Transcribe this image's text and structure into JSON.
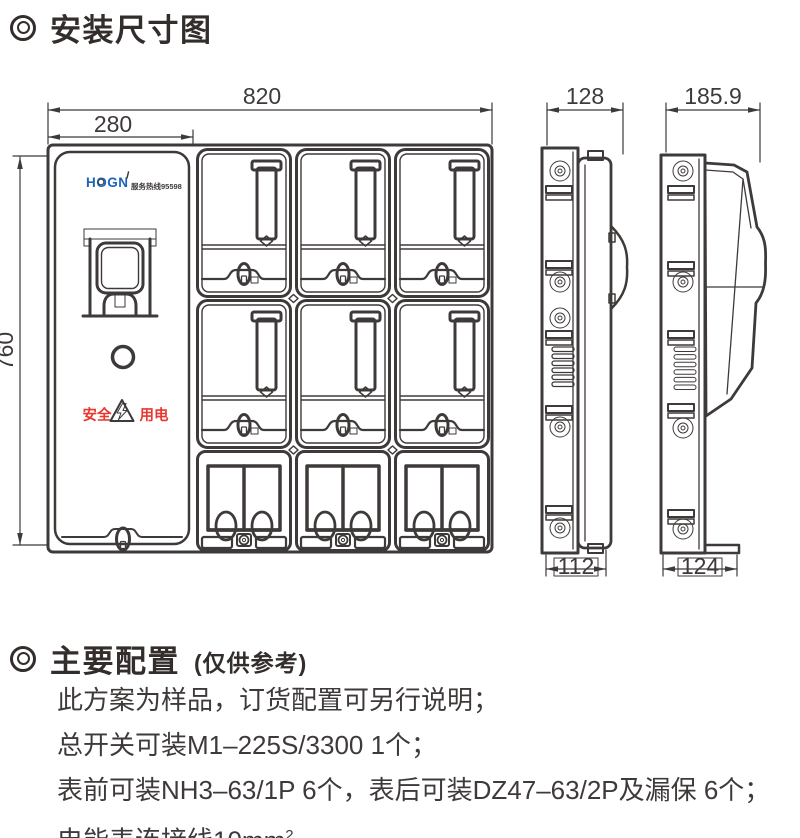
{
  "title": "安装尺寸图",
  "drawing": {
    "dims": {
      "front_width": "820",
      "door_width": "280",
      "front_height": "760",
      "side_depth": "128",
      "side_bottom_depth": "112",
      "door_open_depth": "185.9",
      "door_open_bottom_depth": "124"
    },
    "front": {
      "logo": "HOGN",
      "hotline": "服务热线95598",
      "safety_left": "安全",
      "safety_right": "用电"
    }
  },
  "config": {
    "heading": "主要配置",
    "heading_note": "(仅供参考)",
    "lines": [
      "此方案为样品，订货配置可另行说明；",
      "总开关可装M1–225S/3300  1个；",
      "表前可装NH3–63/1P  6个，表后可装DZ47–63/2P及漏保  6个；"
    ],
    "last_line": {
      "pre": "电能表连接线10mm",
      "sup": "2",
      "post": "。"
    }
  },
  "colors": {
    "line": "#3e3a39",
    "logo_blue": "#1c63b7",
    "safety_red": "#e8382f"
  }
}
